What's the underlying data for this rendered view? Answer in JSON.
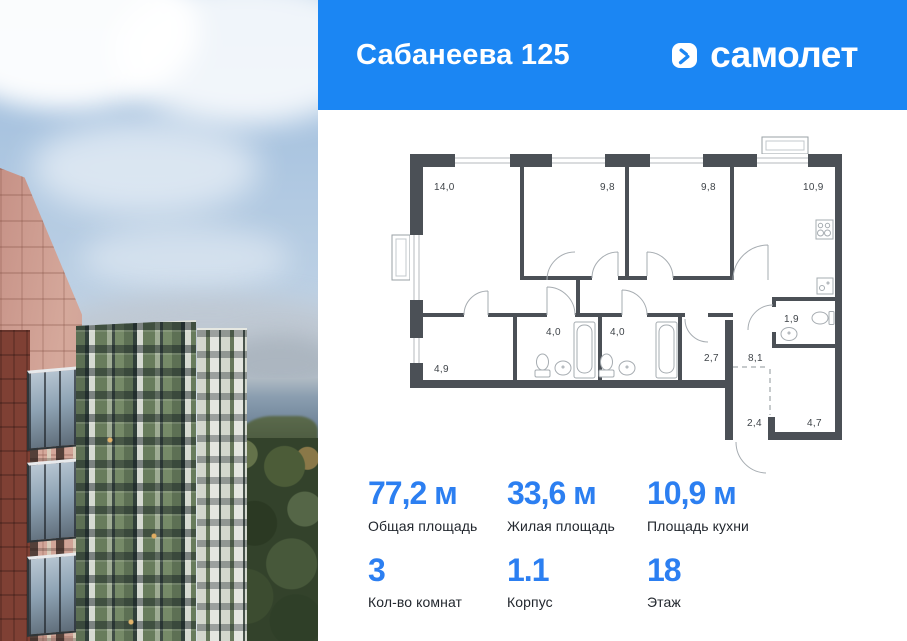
{
  "header": {
    "title": "Сабанеева 125",
    "brand": "самолет"
  },
  "colors": {
    "header_bg": "#1b86f3",
    "accent": "#2c7ff1",
    "plan_wall": "#4b5056"
  },
  "photo": {
    "alt": "Вид на жилые дома у моря"
  },
  "floorplan": {
    "rooms": [
      {
        "label": "14,0"
      },
      {
        "label": "9,8"
      },
      {
        "label": "9,8"
      },
      {
        "label": "10,9"
      },
      {
        "label": "4,0"
      },
      {
        "label": "4,0"
      },
      {
        "label": "4,9"
      },
      {
        "label": "2,7"
      },
      {
        "label": "8,1"
      },
      {
        "label": "1,9"
      },
      {
        "label": "2,4"
      },
      {
        "label": "4,7"
      }
    ]
  },
  "stats": {
    "cells": [
      {
        "value": "77,2 м",
        "label": "Общая площадь"
      },
      {
        "value": "33,6 м",
        "label": "Жилая площадь"
      },
      {
        "value": "10,9 м",
        "label": "Площадь кухни"
      },
      {
        "value": "3",
        "label": "Кол-во комнат"
      },
      {
        "value": "1.1",
        "label": "Корпус"
      },
      {
        "value": "18",
        "label": "Этаж"
      }
    ]
  }
}
